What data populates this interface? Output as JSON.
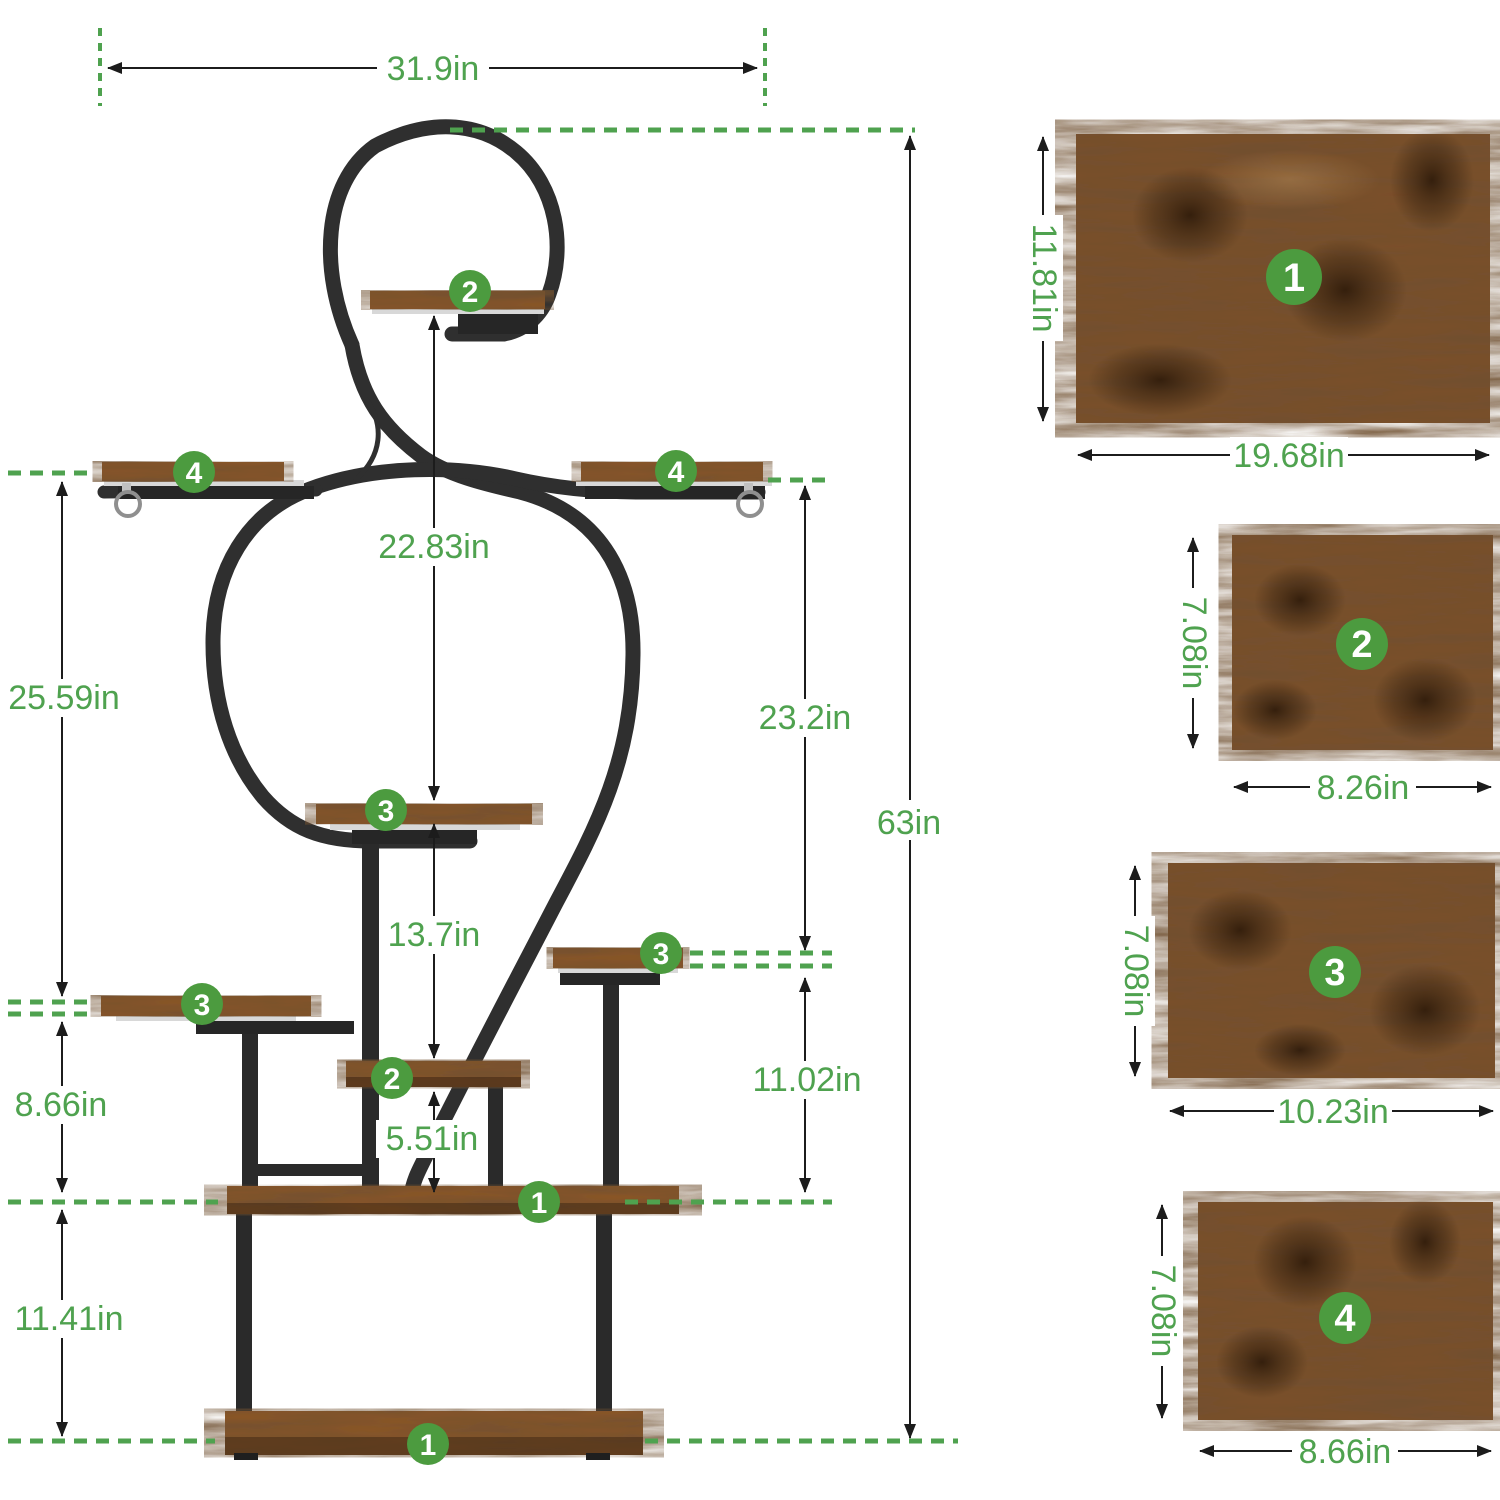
{
  "meta": {
    "description": "Plant stand dimension diagram with four numbered wood shelf panels",
    "colors": {
      "dimension_green": "#4fa24f",
      "badge_green": "#4c9b3f",
      "metal_dark": "#2f2f2f",
      "wood_brown": "#8a5526"
    }
  },
  "stand": {
    "overall_width": "31.9in",
    "overall_height": "63in",
    "left_dims": {
      "upper": "25.59in",
      "middle": "8.66in",
      "lower": "11.41in"
    },
    "center_dims": {
      "upper": "22.83in",
      "middle": "13.7in",
      "lower": "5.51in"
    },
    "right_dims": {
      "upper": "23.2in",
      "lower": "11.02in"
    },
    "badges": {
      "top_shelf2": "2",
      "left_shelf4": "4",
      "right_shelf4": "4",
      "middle_shelf3": "3",
      "left_shelf3": "3",
      "right_shelf3": "3",
      "lower_shelf2": "2",
      "platform": "1",
      "base": "1"
    }
  },
  "panels": [
    {
      "num": "1",
      "height_label": "11.81in",
      "width_label": "19.68in"
    },
    {
      "num": "2",
      "height_label": "7.08in",
      "width_label": "8.26in"
    },
    {
      "num": "3",
      "height_label": "7.08in",
      "width_label": "10.23in"
    },
    {
      "num": "4",
      "height_label": "7.08in",
      "width_label": "8.66in"
    }
  ]
}
